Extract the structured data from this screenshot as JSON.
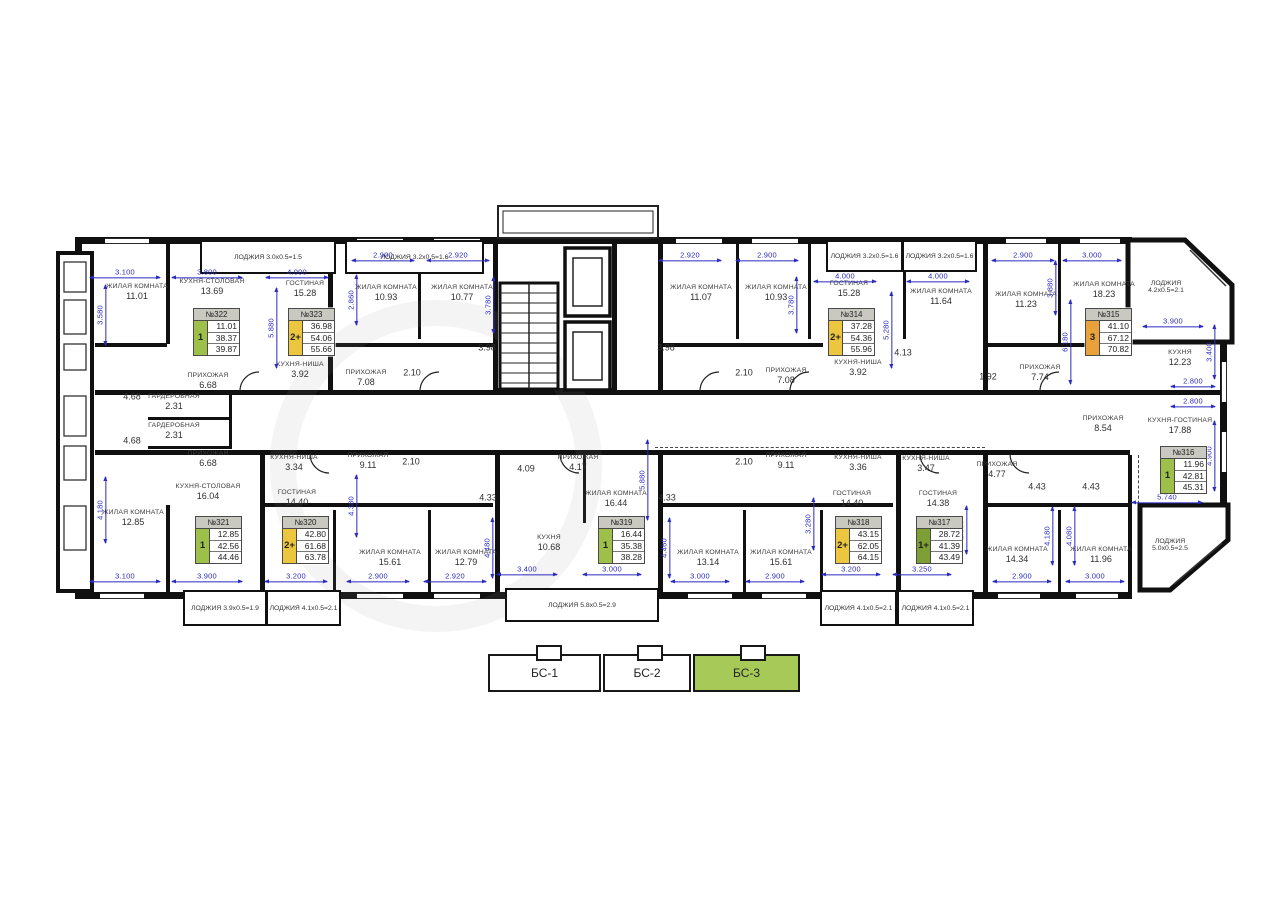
{
  "plan": {
    "colors": {
      "type_1": "#9cc04a",
      "type_1p": "#7d9f35",
      "type_2p": "#ecc63e",
      "type_3": "#e9a23b",
      "dim_blue": "#2b2bc0",
      "wall_black": "#101010",
      "section_highlight": "#a6c958",
      "card_header_bg": "#c9c9c2"
    },
    "cards": [
      {
        "number": "№322",
        "type": "1",
        "type_key": "type_1",
        "values": [
          "11.01",
          "38.37",
          "39.87"
        ],
        "x": 193,
        "y": 308
      },
      {
        "number": "№323",
        "type": "2+",
        "type_key": "type_2p",
        "values": [
          "36.98",
          "54.06",
          "55.66"
        ],
        "x": 288,
        "y": 308
      },
      {
        "number": "№314",
        "type": "2+",
        "type_key": "type_2p",
        "values": [
          "37.28",
          "54.36",
          "55.96"
        ],
        "x": 828,
        "y": 308
      },
      {
        "number": "№315",
        "type": "3",
        "type_key": "type_3",
        "values": [
          "41.10",
          "67.12",
          "70.82"
        ],
        "x": 1085,
        "y": 308
      },
      {
        "number": "№316",
        "type": "1",
        "type_key": "type_1",
        "values": [
          "11.96",
          "42.81",
          "45.31"
        ],
        "x": 1160,
        "y": 446
      },
      {
        "number": "№317",
        "type": "1+",
        "type_key": "type_1p",
        "values": [
          "28.72",
          "41.39",
          "43.49"
        ],
        "x": 916,
        "y": 516
      },
      {
        "number": "№318",
        "type": "2+",
        "type_key": "type_2p",
        "values": [
          "43.15",
          "62.05",
          "64.15"
        ],
        "x": 835,
        "y": 516
      },
      {
        "number": "№319",
        "type": "1",
        "type_key": "type_1",
        "values": [
          "16.44",
          "35.38",
          "38.28"
        ],
        "x": 598,
        "y": 516
      },
      {
        "number": "№320",
        "type": "2+",
        "type_key": "type_2p",
        "values": [
          "42.80",
          "61.68",
          "63.78"
        ],
        "x": 282,
        "y": 516
      },
      {
        "number": "№321",
        "type": "1",
        "type_key": "type_1",
        "values": [
          "12.85",
          "42.56",
          "44.46"
        ],
        "x": 195,
        "y": 516
      }
    ],
    "rooms": [
      {
        "n": "ЖИЛАЯ КОМНАТА",
        "a": "11.01",
        "x": 137,
        "y": 292
      },
      {
        "n": "КУХНЯ-СТОЛОВАЯ",
        "a": "13.69",
        "x": 212,
        "y": 287
      },
      {
        "n": "ГОСТИНАЯ",
        "a": "15.28",
        "x": 305,
        "y": 289
      },
      {
        "n": "ЖИЛАЯ КОМНАТА",
        "a": "10.93",
        "x": 386,
        "y": 293
      },
      {
        "n": "ЖИЛАЯ КОМНАТА",
        "a": "10.77",
        "x": 462,
        "y": 293
      },
      {
        "n": "ЖИЛАЯ КОМНАТА",
        "a": "11.07",
        "x": 701,
        "y": 293
      },
      {
        "n": "ЖИЛАЯ КОМНАТА",
        "a": "10.93",
        "x": 776,
        "y": 293
      },
      {
        "n": "ГОСТИНАЯ",
        "a": "15.28",
        "x": 849,
        "y": 289
      },
      {
        "n": "ЖИЛАЯ КОМНАТА",
        "a": "11.64",
        "x": 941,
        "y": 297
      },
      {
        "n": "ЖИЛАЯ КОМНАТА",
        "a": "11.23",
        "x": 1026,
        "y": 300
      },
      {
        "n": "ЖИЛАЯ КОМНАТА",
        "a": "18.23",
        "x": 1104,
        "y": 290
      },
      {
        "n": "КУХНЯ",
        "a": "12.23",
        "x": 1180,
        "y": 358
      },
      {
        "n": "ПРИХОЖАЯ",
        "a": "6.68",
        "x": 208,
        "y": 381
      },
      {
        "n": "КУХНЯ-НИША",
        "a": "3.92",
        "x": 300,
        "y": 370
      },
      {
        "n": "ПРИХОЖАЯ",
        "a": "7.08",
        "x": 366,
        "y": 378
      },
      {
        "n": "",
        "a": "2.10",
        "x": 412,
        "y": 372
      },
      {
        "n": "",
        "a": "3.98",
        "x": 487,
        "y": 347
      },
      {
        "n": "",
        "a": "3.98",
        "x": 666,
        "y": 347
      },
      {
        "n": "",
        "a": "2.10",
        "x": 744,
        "y": 372
      },
      {
        "n": "ПРИХОЖАЯ",
        "a": "7.08",
        "x": 786,
        "y": 376
      },
      {
        "n": "КУХНЯ-НИША",
        "a": "3.92",
        "x": 858,
        "y": 368
      },
      {
        "n": "",
        "a": "4.13",
        "x": 903,
        "y": 352
      },
      {
        "n": "",
        "a": "1.92",
        "x": 988,
        "y": 376
      },
      {
        "n": "ПРИХОЖАЯ",
        "a": "7.74",
        "x": 1040,
        "y": 373
      },
      {
        "n": "ПРИХОЖАЯ",
        "a": "8.54",
        "x": 1103,
        "y": 424
      },
      {
        "n": "КУХНЯ-ГОСТИНАЯ",
        "a": "17.88",
        "x": 1180,
        "y": 426
      },
      {
        "n": "ГАРДЕРОБНАЯ",
        "a": "2.31",
        "x": 174,
        "y": 402
      },
      {
        "n": "ГАРДЕРОБНАЯ",
        "a": "2.31",
        "x": 174,
        "y": 431
      },
      {
        "n": "",
        "a": "4.68",
        "x": 132,
        "y": 396
      },
      {
        "n": "",
        "a": "4.68",
        "x": 132,
        "y": 440
      },
      {
        "n": "ПРИХОЖАЯ",
        "a": "6.68",
        "x": 208,
        "y": 459
      },
      {
        "n": "ЖИЛАЯ КОМНАТА",
        "a": "12.85",
        "x": 133,
        "y": 518
      },
      {
        "n": "КУХНЯ-СТОЛОВАЯ",
        "a": "16.04",
        "x": 208,
        "y": 492
      },
      {
        "n": "КУХНЯ-НИША",
        "a": "3.34",
        "x": 294,
        "y": 463
      },
      {
        "n": "ГОСТИНАЯ",
        "a": "14.40",
        "x": 297,
        "y": 498
      },
      {
        "n": "ПРИХОЖАЯ",
        "a": "9.11",
        "x": 368,
        "y": 461
      },
      {
        "n": "",
        "a": "2.10",
        "x": 411,
        "y": 461
      },
      {
        "n": "",
        "a": "4.33",
        "x": 488,
        "y": 497
      },
      {
        "n": "",
        "a": "4.09",
        "x": 526,
        "y": 468
      },
      {
        "n": "ПРИХОЖАЯ",
        "a": "4.17",
        "x": 578,
        "y": 463
      },
      {
        "n": "ЖИЛАЯ КОМНАТА",
        "a": "16.44",
        "x": 616,
        "y": 499
      },
      {
        "n": "КУХНЯ",
        "a": "10.68",
        "x": 549,
        "y": 543
      },
      {
        "n": "ЖИЛАЯ КОМНАТА",
        "a": "15.61",
        "x": 390,
        "y": 558
      },
      {
        "n": "ЖИЛАЯ КОМНАТА",
        "a": "12.79",
        "x": 466,
        "y": 558
      },
      {
        "n": "",
        "a": "2.10",
        "x": 744,
        "y": 461
      },
      {
        "n": "ПРИХОЖАЯ",
        "a": "9.11",
        "x": 786,
        "y": 461
      },
      {
        "n": "",
        "a": "4.33",
        "x": 667,
        "y": 497
      },
      {
        "n": "КУХНЯ-НИША",
        "a": "3.36",
        "x": 858,
        "y": 463
      },
      {
        "n": "ГОСТИНАЯ",
        "a": "14.40",
        "x": 852,
        "y": 499
      },
      {
        "n": "КУХНЯ-НИША",
        "a": "3.47",
        "x": 926,
        "y": 464
      },
      {
        "n": "ГОСТИНАЯ",
        "a": "14.38",
        "x": 938,
        "y": 499
      },
      {
        "n": "ЖИЛАЯ КОМНАТА",
        "a": "13.14",
        "x": 708,
        "y": 558
      },
      {
        "n": "ЖИЛАЯ КОМНАТА",
        "a": "15.61",
        "x": 781,
        "y": 558
      },
      {
        "n": "ПРИХОЖАЯ",
        "a": "4.77",
        "x": 997,
        "y": 470
      },
      {
        "n": "",
        "a": "4.43",
        "x": 1037,
        "y": 486
      },
      {
        "n": "",
        "a": "4.43",
        "x": 1091,
        "y": 486
      },
      {
        "n": "ЖИЛАЯ КОМНАТА",
        "a": "14.34",
        "x": 1017,
        "y": 555
      },
      {
        "n": "ЖИЛАЯ КОМНАТА",
        "a": "11.96",
        "x": 1101,
        "y": 555
      }
    ],
    "dims": [
      {
        "t": "3.100",
        "x": 125,
        "y": 273,
        "w": 70
      },
      {
        "t": "3.800",
        "x": 207,
        "y": 273,
        "w": 70
      },
      {
        "t": "4.000",
        "x": 297,
        "y": 273,
        "w": 62
      },
      {
        "t": "2.900",
        "x": 383,
        "y": 256,
        "w": 62
      },
      {
        "t": "2.920",
        "x": 458,
        "y": 256,
        "w": 62
      },
      {
        "t": "2.920",
        "x": 690,
        "y": 256,
        "w": 62
      },
      {
        "t": "2.900",
        "x": 767,
        "y": 256,
        "w": 62
      },
      {
        "t": "4.000",
        "x": 845,
        "y": 277,
        "w": 62
      },
      {
        "t": "4.000",
        "x": 938,
        "y": 277,
        "w": 62
      },
      {
        "t": "2.900",
        "x": 1023,
        "y": 256,
        "w": 62
      },
      {
        "t": "3.000",
        "x": 1092,
        "y": 256,
        "w": 58
      },
      {
        "t": "3.900",
        "x": 1173,
        "y": 322,
        "w": 60
      },
      {
        "t": "3.100",
        "x": 125,
        "y": 577,
        "w": 70
      },
      {
        "t": "3.900",
        "x": 207,
        "y": 577,
        "w": 70
      },
      {
        "t": "3.200",
        "x": 296,
        "y": 577,
        "w": 62
      },
      {
        "t": "2.900",
        "x": 378,
        "y": 577,
        "w": 62
      },
      {
        "t": "2.920",
        "x": 455,
        "y": 577,
        "w": 62
      },
      {
        "t": "3.400",
        "x": 527,
        "y": 570,
        "w": 60
      },
      {
        "t": "3.000",
        "x": 612,
        "y": 570,
        "w": 58
      },
      {
        "t": "3.000",
        "x": 700,
        "y": 577,
        "w": 58
      },
      {
        "t": "2.900",
        "x": 775,
        "y": 577,
        "w": 58
      },
      {
        "t": "3.200",
        "x": 851,
        "y": 570,
        "w": 58
      },
      {
        "t": "3.250",
        "x": 922,
        "y": 570,
        "w": 58
      },
      {
        "t": "2.900",
        "x": 1022,
        "y": 577,
        "w": 58
      },
      {
        "t": "3.000",
        "x": 1095,
        "y": 577,
        "w": 58
      },
      {
        "t": "3.580",
        "x": 101,
        "y": 315,
        "r": 1,
        "w": 60
      },
      {
        "t": "4.180",
        "x": 101,
        "y": 510,
        "r": 1,
        "w": 66
      },
      {
        "t": "3.780",
        "x": 489,
        "y": 305,
        "r": 1,
        "w": 56
      },
      {
        "t": "3.780",
        "x": 792,
        "y": 305,
        "r": 1,
        "w": 56
      },
      {
        "t": "2.860",
        "x": 352,
        "y": 300,
        "r": 1,
        "w": 50
      },
      {
        "t": "5.880",
        "x": 272,
        "y": 328,
        "r": 1,
        "w": 80
      },
      {
        "t": "5.280",
        "x": 887,
        "y": 330,
        "r": 1,
        "w": 76
      },
      {
        "t": "3.880",
        "x": 1051,
        "y": 288,
        "r": 1,
        "w": 54
      },
      {
        "t": "6.180",
        "x": 1066,
        "y": 342,
        "r": 1,
        "w": 84
      },
      {
        "t": "3.400",
        "x": 1210,
        "y": 352,
        "r": 1,
        "w": 54
      },
      {
        "t": "2.800",
        "x": 1193,
        "y": 382,
        "w": 44
      },
      {
        "t": "2.800",
        "x": 1193,
        "y": 402,
        "w": 44
      },
      {
        "t": "4.900",
        "x": 1210,
        "y": 456,
        "r": 1,
        "w": 70
      },
      {
        "t": "5.740",
        "x": 1167,
        "y": 498,
        "w": 70
      },
      {
        "t": "5.880",
        "x": 643,
        "y": 480,
        "r": 1,
        "w": 80
      },
      {
        "t": "4.380",
        "x": 352,
        "y": 506,
        "r": 1,
        "w": 62
      },
      {
        "t": "3.280",
        "x": 809,
        "y": 524,
        "r": 1,
        "w": 52
      },
      {
        "t": "4.480",
        "x": 488,
        "y": 548,
        "r": 1,
        "w": 60
      },
      {
        "t": "4.460",
        "x": 665,
        "y": 548,
        "r": 1,
        "w": 60
      },
      {
        "t": "2.980",
        "x": 962,
        "y": 530,
        "r": 1,
        "w": 48
      },
      {
        "t": "4.180",
        "x": 1048,
        "y": 536,
        "r": 1,
        "w": 58
      },
      {
        "t": "4.080",
        "x": 1070,
        "y": 536,
        "r": 1,
        "w": 58
      }
    ],
    "loggias": [
      {
        "label": "ЛОДЖИЯ 3.0x0.5=1.5",
        "x": 200,
        "y": 240,
        "w": 132,
        "h": 30
      },
      {
        "label": "ЛОДЖИЯ 3.2x0.5=1.6",
        "x": 345,
        "y": 240,
        "w": 135,
        "h": 30
      },
      {
        "label": "ЛОДЖИЯ 3.2x0.5=1.6",
        "x": 826,
        "y": 240,
        "w": 73,
        "h": 28
      },
      {
        "label": "ЛОДЖИЯ 3.2x0.5=1.6",
        "x": 902,
        "y": 240,
        "w": 71,
        "h": 28
      },
      {
        "label": "ЛОДЖИЯ 3.9x0.5=1.9",
        "x": 183,
        "y": 590,
        "w": 80,
        "h": 32
      },
      {
        "label": "ЛОДЖИЯ 4.1x0.5=2.1",
        "x": 266,
        "y": 590,
        "w": 71,
        "h": 32
      },
      {
        "label": "ЛОДЖИЯ 5.8x0.5=2.9",
        "x": 505,
        "y": 588,
        "w": 150,
        "h": 30
      },
      {
        "label": "ЛОДЖИЯ 4.1x0.5=2.1",
        "x": 820,
        "y": 590,
        "w": 73,
        "h": 32
      },
      {
        "label": "ЛОДЖИЯ 4.1x0.5=2.1",
        "x": 897,
        "y": 590,
        "w": 73,
        "h": 32
      }
    ],
    "bay_labels": [
      {
        "lines": [
          "ЛОДЖИЯ",
          "4.2x0.5=2.1"
        ],
        "x": 1166,
        "y": 287
      },
      {
        "lines": [
          "ЛОДЖИЯ",
          "5.0x0.5=2.5"
        ],
        "x": 1170,
        "y": 545
      }
    ],
    "sections": {
      "items": [
        {
          "label": "БС-1",
          "x": 488,
          "w": 113,
          "highlight": false
        },
        {
          "label": "БС-2",
          "x": 603,
          "w": 88,
          "highlight": false
        },
        {
          "label": "БС-3",
          "x": 693,
          "w": 107,
          "highlight": true
        }
      ],
      "bumps": [
        536,
        637,
        740
      ]
    }
  }
}
